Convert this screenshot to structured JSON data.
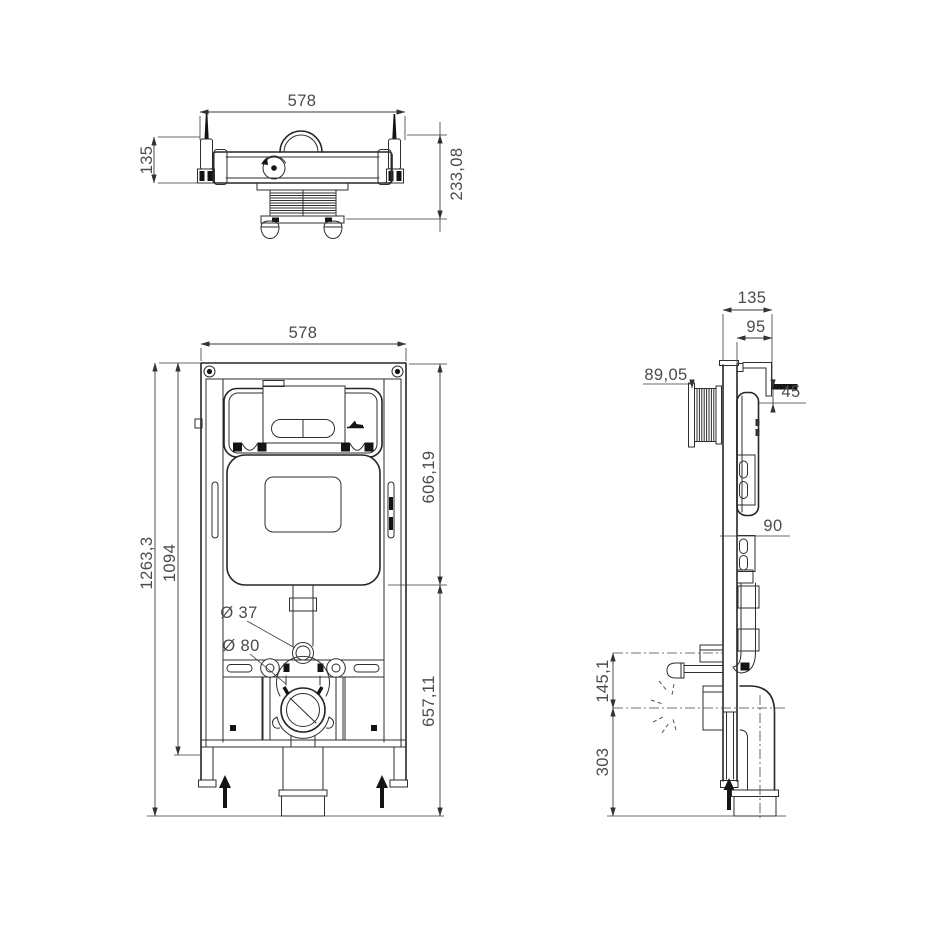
{
  "colors": {
    "line": "#2b2b2b",
    "dimension_text": "#4a4a4a",
    "background": "#ffffff"
  },
  "views": {
    "top": {
      "width": "578",
      "side_height": "135",
      "total_height": "233,08"
    },
    "front": {
      "width": "578",
      "total_height": "1263,3",
      "frame_height": "1094",
      "upper_section": "606,19",
      "lower_section": "657,11",
      "flush_pipe_diameter": "Ø 37",
      "outlet_diameter": "Ø 80"
    },
    "side": {
      "total_depth": "135",
      "frame_depth": "95",
      "inlet_offset": "89,05",
      "bracket_offset": "45",
      "rail_dimension": "90",
      "fixing_stud_height": "145,1",
      "outlet_center_height": "303"
    }
  }
}
